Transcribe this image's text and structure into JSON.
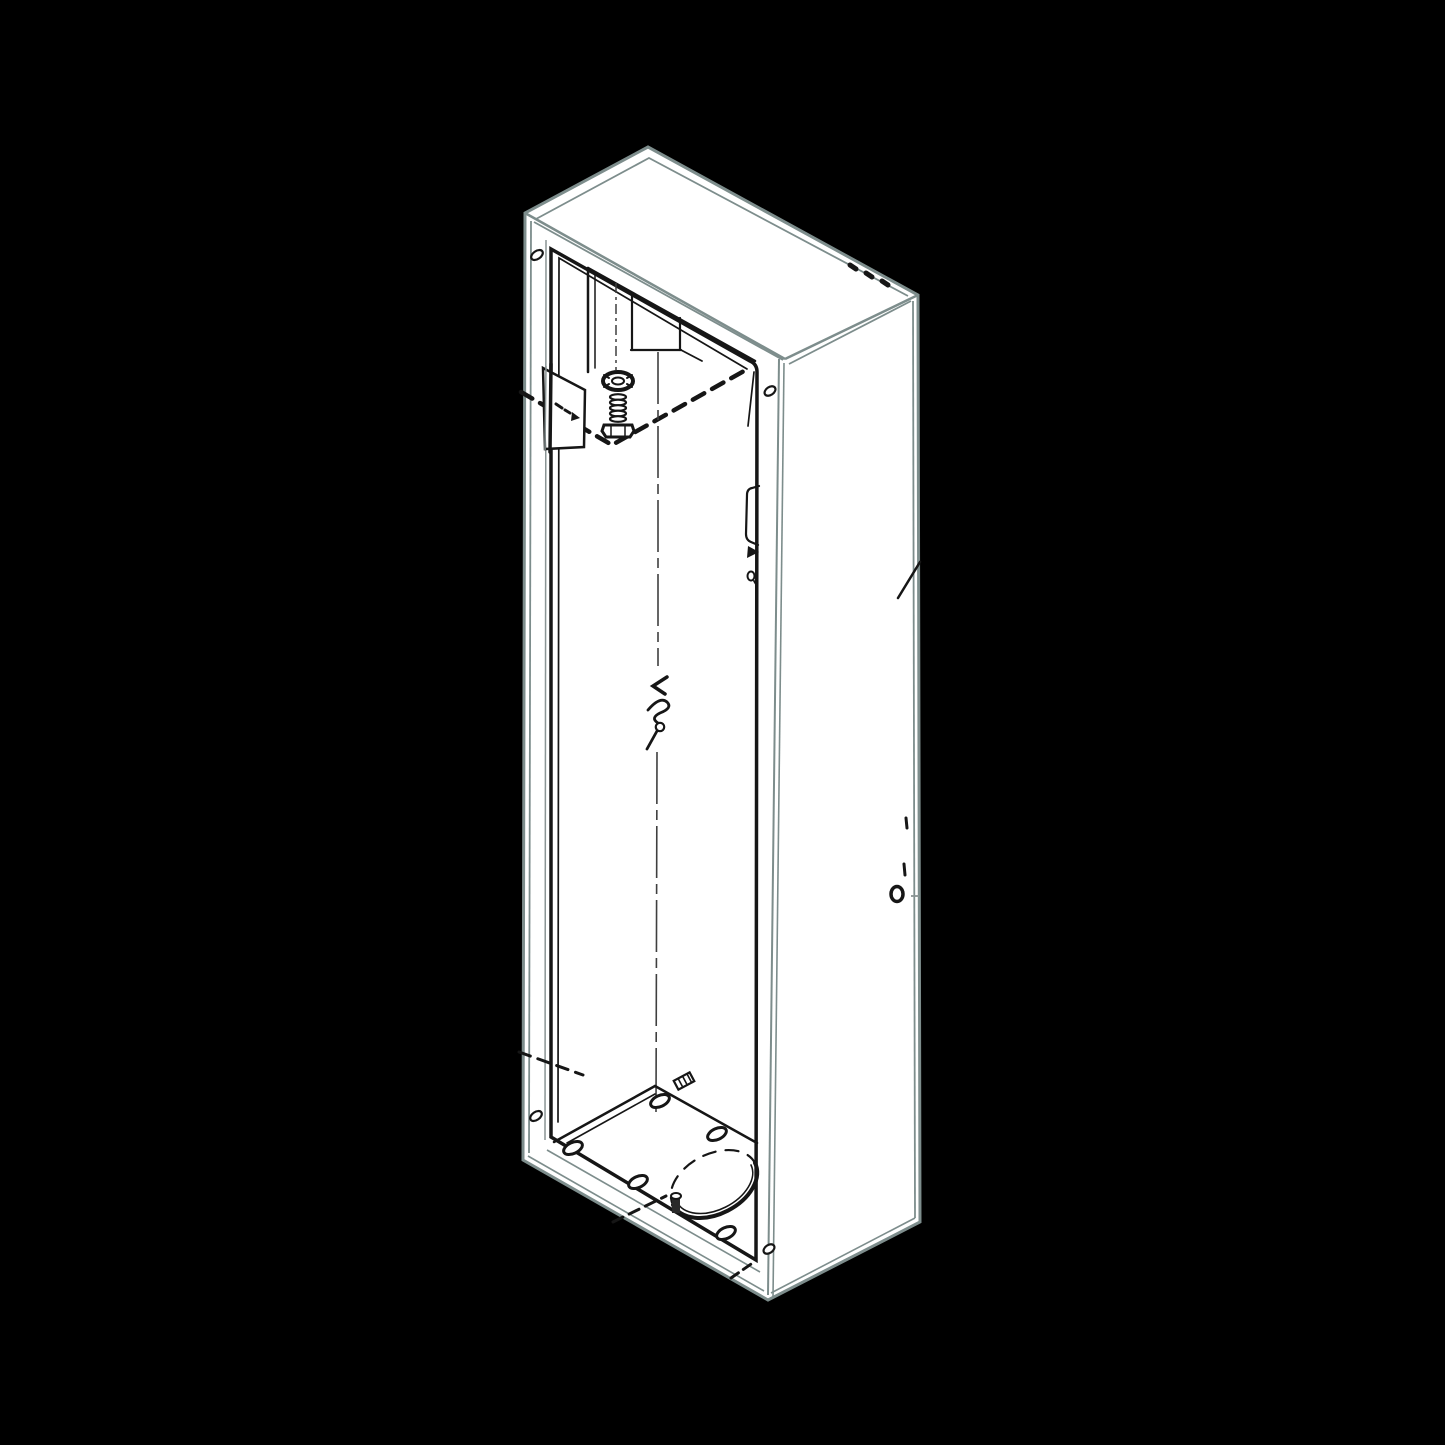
{
  "scene": {
    "type": "technical-line-drawing",
    "view": "isometric",
    "subject": "tall rectangular sheet-metal enclosure cabinet with open front, shown against a black background"
  },
  "colors": {
    "background": "#000000",
    "surface": "#ffffff",
    "outline": "#7d8d8c",
    "detail": "#161616",
    "centerline": "#3f3f3f",
    "muted": "#8a9494"
  },
  "parts": [
    {
      "name": "cabinet-silhouette"
    },
    {
      "name": "top-panel"
    },
    {
      "name": "right-panel"
    },
    {
      "name": "front-opening-frame"
    },
    {
      "name": "corner-gusset"
    },
    {
      "name": "spring-bolt-assembly"
    },
    {
      "name": "mounting-plate"
    },
    {
      "name": "assembly-dashed-lines"
    },
    {
      "name": "center-axis-line"
    },
    {
      "name": "line-break-symbol"
    },
    {
      "name": "cable-clip"
    },
    {
      "name": "floor-panel"
    },
    {
      "name": "floor-holes"
    },
    {
      "name": "cable-knockout"
    },
    {
      "name": "floor-studs"
    },
    {
      "name": "rivet-holes"
    },
    {
      "name": "edge-screws"
    },
    {
      "name": "right-panel-marks"
    }
  ]
}
